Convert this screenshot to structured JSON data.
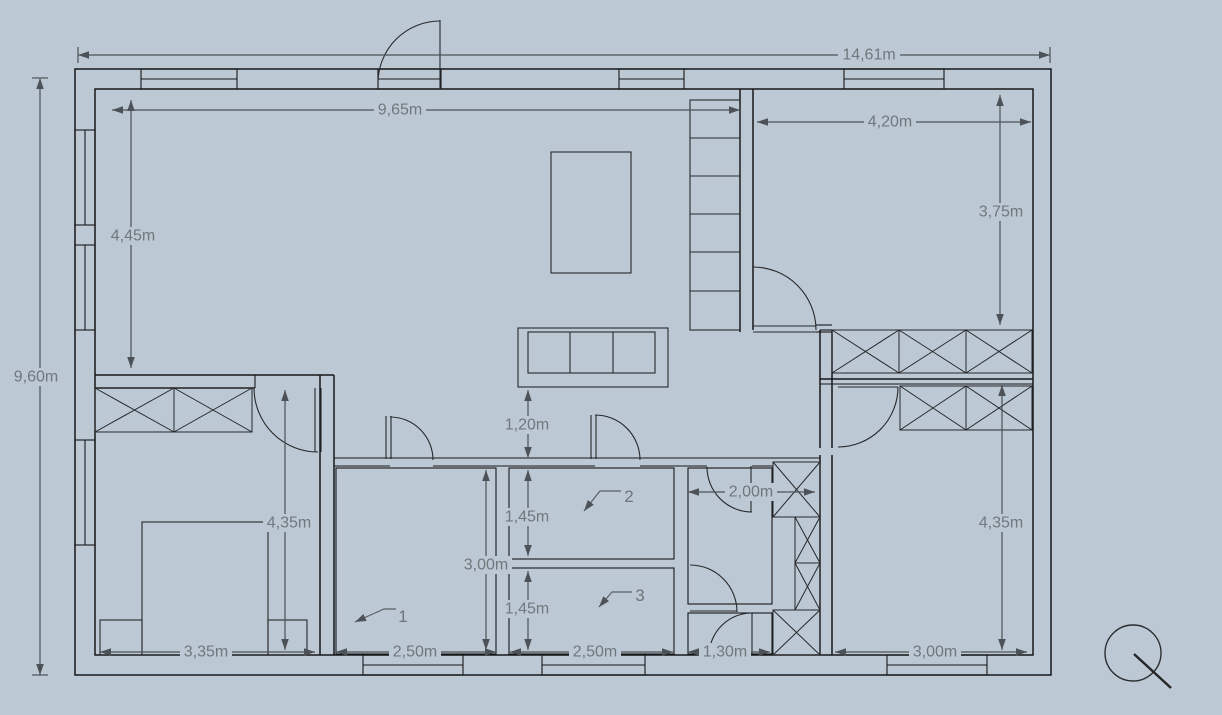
{
  "app": {
    "name": "floor-plan-canvas",
    "view": "2d-plan-top-view"
  },
  "colors": {
    "background": "#bcc8d3",
    "wall": "#17181a",
    "furniture_line": "#26282b",
    "dimension_line": "#4c5257",
    "dimension_text": "#70777d"
  },
  "dimensions": {
    "overall_width": "14,61m",
    "overall_height": "9,60m",
    "living_width": "9,65m",
    "living_height": "4,45m",
    "bedroom_tr_width": "4,20m",
    "bedroom_tr_height": "3,75m",
    "hall_width": "1,20m",
    "bathroom_width": "2,00m",
    "bedroom_bl_height": "4,35m",
    "bedroom_bl_width": "3,35m",
    "room1_height": "3,00m",
    "room2_height": "1,45m",
    "room3_height": "1,45m",
    "room1_width": "2,50m",
    "room3_width": "2,50m",
    "wc_width": "1,30m",
    "bedroom_br_width": "3,00m",
    "bedroom_br_height": "4,35m"
  },
  "room_labels": {
    "room1": "1",
    "room2": "2",
    "room3": "3"
  },
  "icons": {
    "zoom_cursor": "zoom-tool-cursor"
  }
}
